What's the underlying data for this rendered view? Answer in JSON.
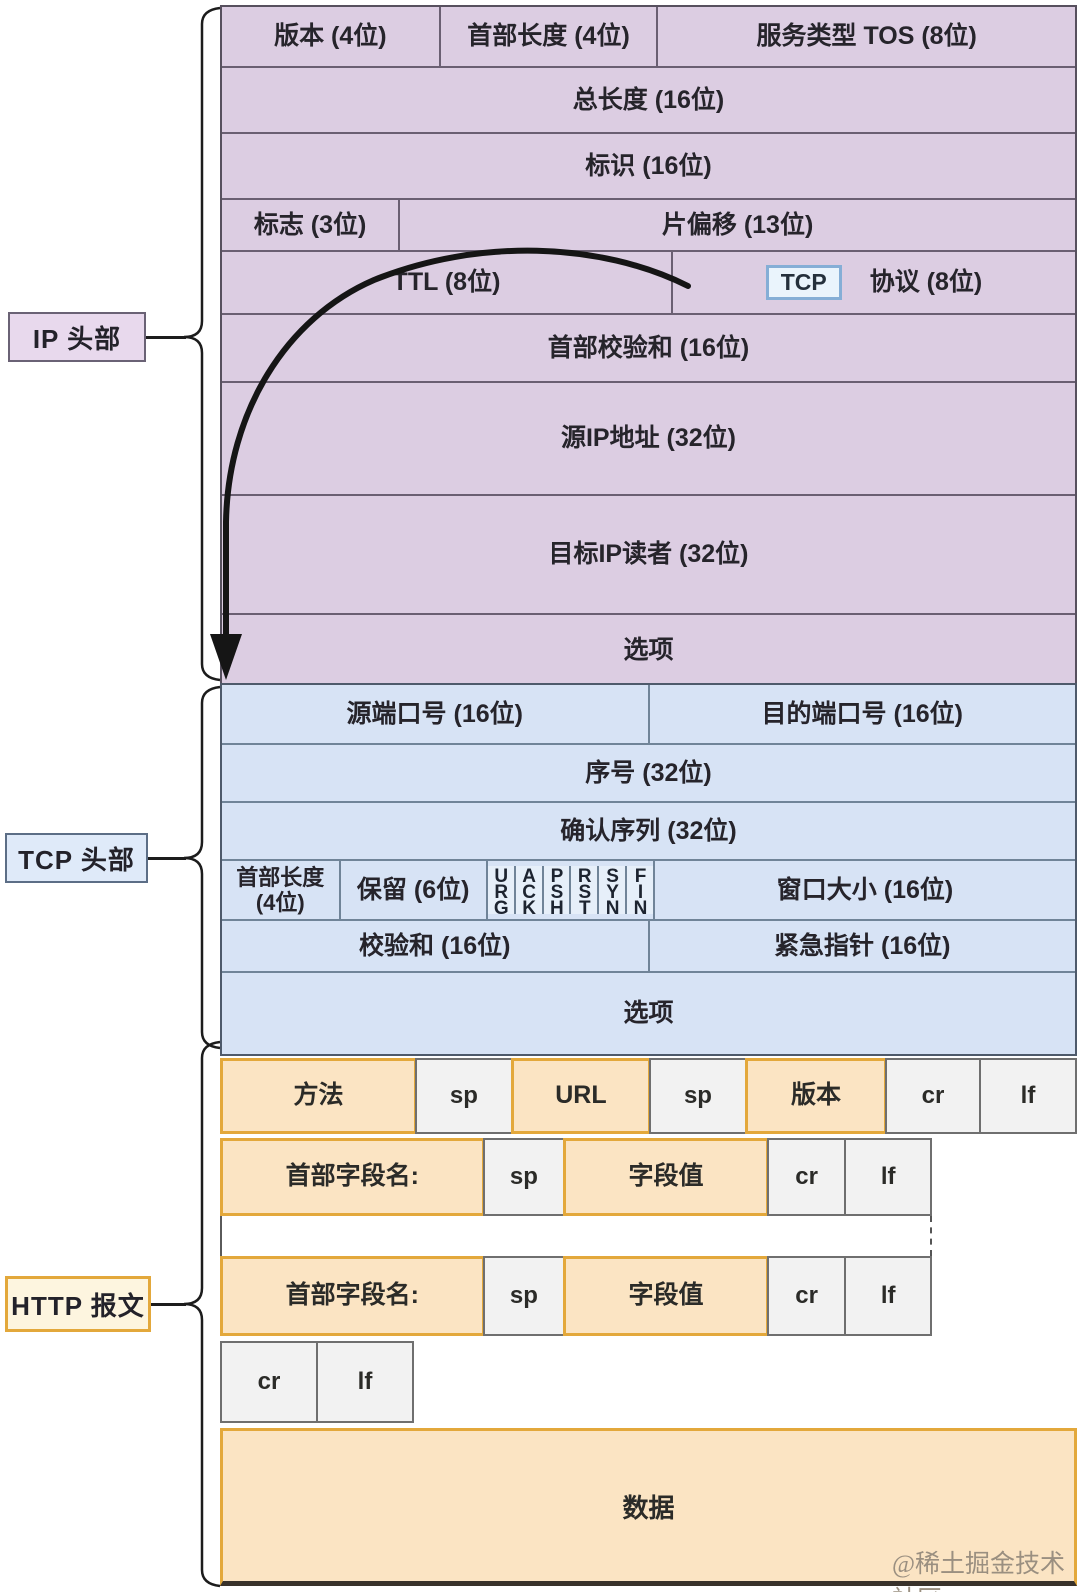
{
  "watermark": "@稀土掘金技术社区",
  "tcp_tag": "TCP",
  "ip": {
    "label": "IP 头部",
    "rows": [
      {
        "cells": [
          "版本 (4位)",
          "首部长度 (4位)",
          "服务类型 TOS (8位)"
        ]
      },
      {
        "cells": [
          "总长度 (16位)"
        ]
      },
      {
        "cells": [
          "标识 (16位)"
        ]
      },
      {
        "cells": [
          "标志 (3位)",
          "片偏移 (13位)"
        ]
      },
      {
        "cells": [
          "TTL (8位)",
          "协议 (8位)"
        ]
      },
      {
        "cells": [
          "首部校验和 (16位)"
        ]
      },
      {
        "cells": [
          "源IP地址 (32位)"
        ]
      },
      {
        "cells": [
          "目标IP读者 (32位)"
        ]
      },
      {
        "cells": [
          "选项"
        ]
      }
    ]
  },
  "tcp": {
    "label": "TCP 头部",
    "rows": [
      {
        "cells": [
          "源端口号 (16位)",
          "目的端口号 (16位)"
        ]
      },
      {
        "cells": [
          "序号 (32位)"
        ]
      },
      {
        "cells": [
          "确认序列 (32位)"
        ]
      },
      {
        "cells": [
          "首部长度 (4位)",
          "保留 (6位)",
          "窗口大小 (16位)"
        ]
      },
      {
        "cells": [
          "校验和 (16位)",
          "紧急指针 (16位)"
        ]
      },
      {
        "cells": [
          "选项"
        ]
      }
    ],
    "flags": [
      "URG",
      "ACK",
      "PSH",
      "RST",
      "SYN",
      "FIN"
    ]
  },
  "http": {
    "label": "HTTP 报文",
    "request_line": [
      "方法",
      "sp",
      "URL",
      "sp",
      "版本",
      "cr",
      "lf"
    ],
    "header_line1": [
      "首部字段名:",
      "sp",
      "字段值",
      "cr",
      "lf"
    ],
    "header_line2": [
      "首部字段名:",
      "sp",
      "字段值",
      "cr",
      "lf"
    ],
    "crlf_line": [
      "cr",
      "lf"
    ],
    "data_label": "数据"
  },
  "colors": {
    "ip_fill": "#dccde2",
    "ip_border": "#57505e",
    "ip_divider": "#6a5f72",
    "ip_label_fill": "#e8d9ed",
    "tcp_fill": "#d7e3f5",
    "tcp_border": "#4e5a6b",
    "tcp_divider": "#708498",
    "tcp_flag_fill": "#e6eff9",
    "tcp_label_fill": "#dfeaf9",
    "tcp_tag_fill": "#eaf4fc",
    "tcp_tag_border": "#85aed6",
    "http_orange_fill": "#fbe4c3",
    "http_orange_border": "#e3a83b",
    "http_white_fill": "#f2f2f2",
    "http_white_border": "#6f6f6f",
    "http_label_fill": "#fdf5df",
    "text": "#26242b",
    "arrow": "#151515",
    "watermark": "#9a8f80"
  }
}
